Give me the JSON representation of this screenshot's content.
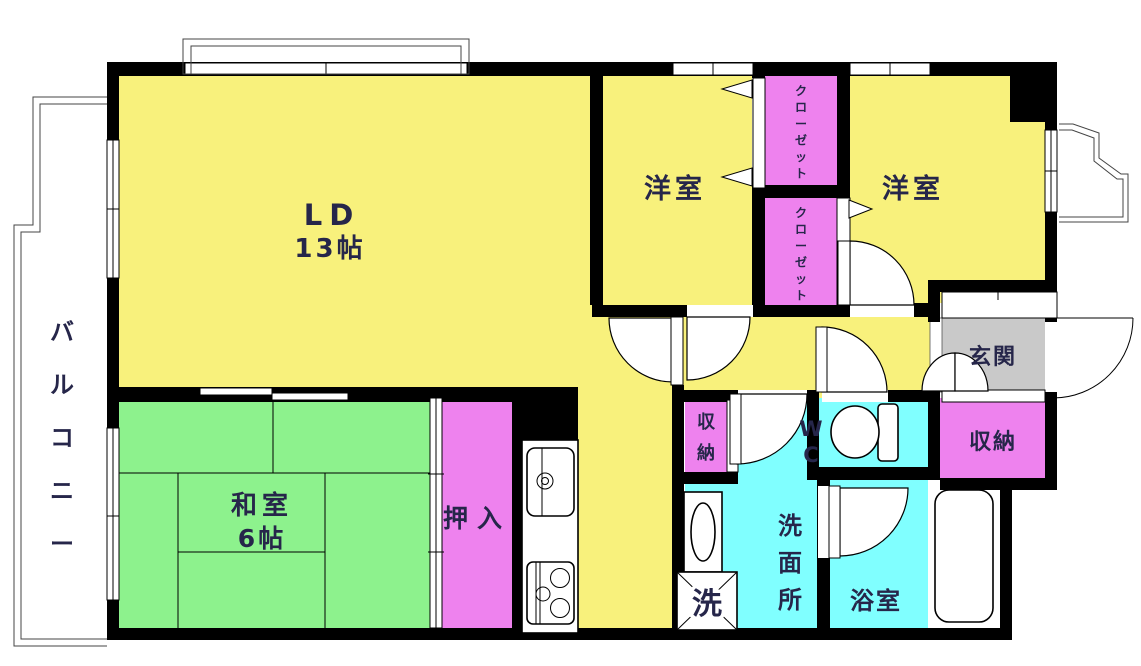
{
  "plan": {
    "type": "floor-plan",
    "colors": {
      "wall": "#000000",
      "room_yellow": "#F8F17C",
      "tatami_green": "#8DF28D",
      "closet_pink": "#EE82EE",
      "wet_cyan": "#80FFFF",
      "entrance_gray": "#C9C9C9",
      "label_text": "#26264a",
      "background": "#FFFFFF"
    },
    "rooms": {
      "living_dining": {
        "label": "LD",
        "size": "13帖"
      },
      "western_room_left": {
        "label": "洋室"
      },
      "western_room_right": {
        "label": "洋室"
      },
      "closet_upper": {
        "label": "クローゼット"
      },
      "closet_lower": {
        "label": "クローゼット"
      },
      "japanese_room": {
        "label": "和室",
        "size": "6帖"
      },
      "oshiire": {
        "label": "押入"
      },
      "balcony": {
        "label": "バルコニー"
      },
      "entrance": {
        "label": "玄関"
      },
      "storage_hall": {
        "label": "収納"
      },
      "storage_entrance": {
        "label": "収納"
      },
      "toilet": {
        "label": "WC"
      },
      "washroom": {
        "label": "洗面所"
      },
      "bathroom": {
        "label": "浴室"
      },
      "washing_machine": {
        "label": "洗"
      }
    }
  }
}
